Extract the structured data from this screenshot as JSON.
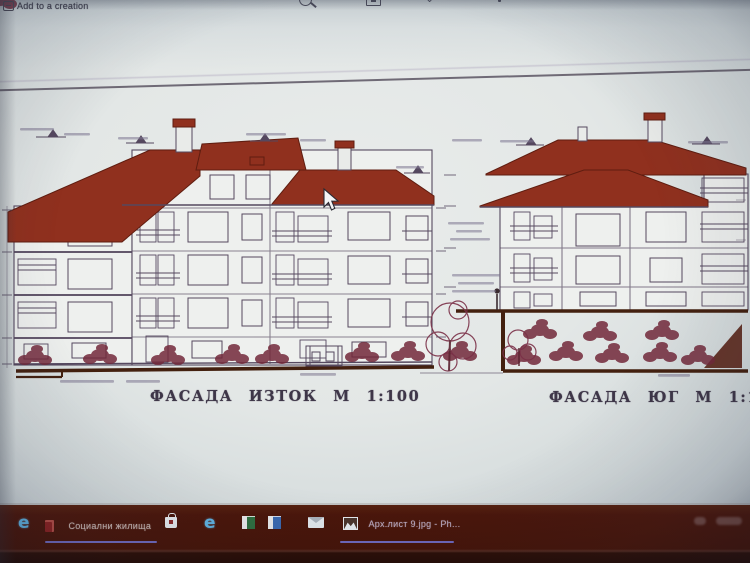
{
  "app": {
    "toolbar": {
      "add_to_creation_label": "Add to a creation",
      "top_icons": [
        "zoom-icon",
        "slideshow-icon",
        "chevron-icon",
        "edit-pen-icon"
      ]
    }
  },
  "drawing": {
    "left_facade_title": "ФАСАДА ИЗТОК М 1:100",
    "right_facade_title": "ФАСАДА ЮГ М 1:100"
  },
  "taskbar": {
    "edge_letter": "e",
    "window1_label": "Социални жилища",
    "window2_label": "Арх.лист 9.jpg - Ph...",
    "pinned_icons": [
      "edge-browser",
      "red-document",
      "store",
      "edge-browser",
      "excel",
      "word",
      "mail",
      "photos"
    ]
  },
  "colors": {
    "roof_red": "#90301e",
    "line_dark": "#55485f",
    "bush": "#722839",
    "ground_brown": "#43200f",
    "sheet": "#e5e8e7",
    "title_ink": "#3e3648",
    "accent_underline": "#7678dd",
    "taskbar_bg": "#4a150a",
    "taskbar_hi": "#56200f",
    "taskbar_lo": "#240a04",
    "edge_blue": "#5fb2e2"
  }
}
